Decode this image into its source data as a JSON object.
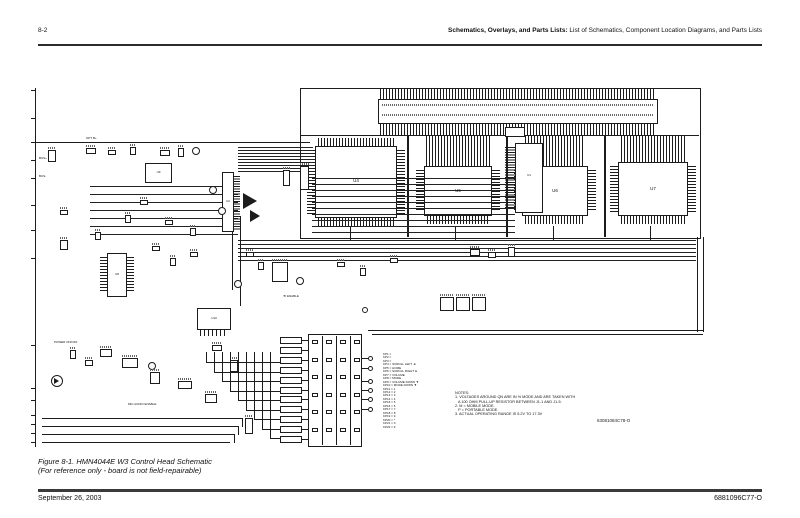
{
  "header": {
    "page_number": "8-2",
    "title_bold": "Schematics, Overlays, and Parts Lists:",
    "title_rest": " List of Schematics, Component Location Diagrams, and Parts Lists"
  },
  "figure": {
    "caption": "Figure 8-1. HMN4044E W3 Control Head Schematic",
    "caption_note": "(For reference only - board is not field-repairable)"
  },
  "footer": {
    "date": "September 26, 2003",
    "doc_number": "6881096C77-O"
  },
  "schematic": {
    "drawing_number": "63081084C78-O",
    "ic_labels": {
      "u1": "U1",
      "u2": "U2",
      "u4": "U4",
      "u5": "U5",
      "u6": "U6",
      "u7": "U7",
      "u8": "U8",
      "u9": "U9",
      "u10": "U10"
    },
    "labels": {
      "opt_b_plus": "OPT B+",
      "bus_plus": "BUS+",
      "bus_minus": "BUS-",
      "power_on_off": "POWER ON/OFF",
      "mic_audio_enable": "MIC AUDIO ENABLE",
      "b_enable": "'B' ENABLE"
    },
    "keypad_legend": [
      "KP1 = ",
      "KP2 = ",
      "KP3 = ",
      "KP4 = SCROLL LEFT ◄",
      "KP5 = HOME",
      "KP6 = SCROLL RIGHT ►",
      "KP7 = VOLUME",
      "KP8 = MODE",
      "KP9 = VOLUME DOWN ▼",
      "KP10 = MODE DOWN ▼",
      "KP11 = 1",
      "KP12 = 2",
      "KP13 = 3",
      "KP14 = 4",
      "KP15 = 5",
      "KP16 = 6",
      "KP17 = 7",
      "KP18 = 8",
      "KP19 = 9",
      "KP20 = *",
      "KP21 = 0",
      "KP22 = #"
    ],
    "notes": [
      "NOTES:",
      "1. VOLTAGES AROUND QN ARE IN % MODE AND ARE TAKEN WITH",
      "   A 100 OHM PULL-UP RESISTOR BETWEEN J1-1 AND J1-5.",
      "2. M = MOBILE MODE.",
      "   P = PORTABLE MODE.",
      "3. ACTUAL OPERATING RANGE IS 5.2V TO 17.3V"
    ]
  }
}
